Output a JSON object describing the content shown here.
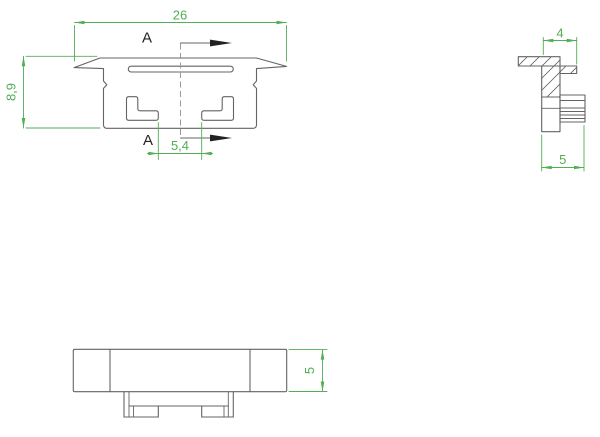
{
  "colors": {
    "dimension": "#52ad55",
    "line": "#646464",
    "section_marker": "#222222",
    "centerline": "#9a9a9a",
    "background": "#ffffff"
  },
  "views": {
    "section": {
      "label_width": "26",
      "label_height": "8,9",
      "label_slot": "5,4",
      "marker_top": "A",
      "marker_bottom": "A"
    },
    "side": {
      "label_width": "4",
      "label_depth": "5"
    },
    "front": {
      "label_height": "5"
    }
  }
}
